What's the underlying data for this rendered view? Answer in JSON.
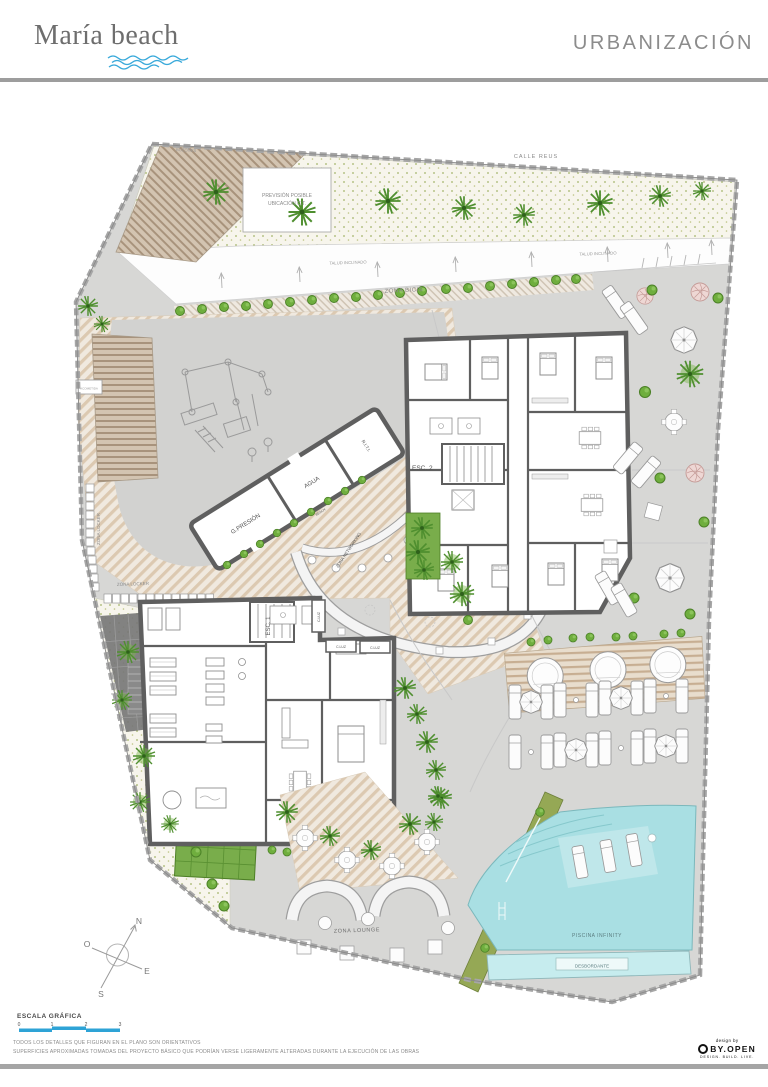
{
  "header": {
    "logo": "María beach",
    "title": "URBANIZACIÓN"
  },
  "plan": {
    "calle": "CALLE REUS",
    "buzones": "BUZONES",
    "ct1": "PREVISIÓN POSIBLE",
    "ct2": "UBICACIÓN C.T.",
    "talud1": "TALUD INCLINADO",
    "talud2": "TALUD INCLINADO",
    "bicis": "ZONA BICIS",
    "locker_v": "ZONA LOCKER",
    "locker_h": "ZONA LOCKER",
    "acometida": "ACOMETIDA",
    "gpresion": "G.PRESIÓN",
    "agua": "AGUA",
    "riti": "R.I.T.I.",
    "barra1": "BARRA",
    "barra2": "BEACH",
    "networking": "ZONA NETWORKING",
    "esc2": "ESC. 2",
    "esc1": "ESC. 1",
    "cluz": [
      "C.LUZ",
      "C.LUZ",
      "C.LUZ"
    ],
    "lounge": "ZONA LOUNGE",
    "piscina": "PISCINA INFINITY",
    "desbordante": "DESBORDANTE"
  },
  "compass": {
    "n": "N",
    "s": "S",
    "e": "E",
    "o": "O"
  },
  "scale_bar": {
    "title": "ESCALA GRÁFICA",
    "ticks": [
      "0",
      "1",
      "2",
      "3"
    ]
  },
  "disclaimer": {
    "line1": "TODOS LOS DETALLES QUE FIGURAN EN EL PLANO SON ORIENTATIVOS",
    "line2": "SUPERFICIES APROXIMADAS TOMADAS DEL PROYECTO BÁSICO QUE PODRÍAN VERSE LIGERAMENTE ALTERADAS DURANTE LA EJECUCIÓN DE LAS OBRAS"
  },
  "brand": {
    "design_by": "design by",
    "name": "BY.OPEN",
    "tagline": "DESIGN. BUILD. LIVE."
  },
  "colors": {
    "accent_blue": "#2ea3d6",
    "pool": "#a9dfe3",
    "vegetation": "#6fae3e",
    "deck": "#cdbba6",
    "paving": "#d7d7d5",
    "wall": "#5f5f5f"
  }
}
